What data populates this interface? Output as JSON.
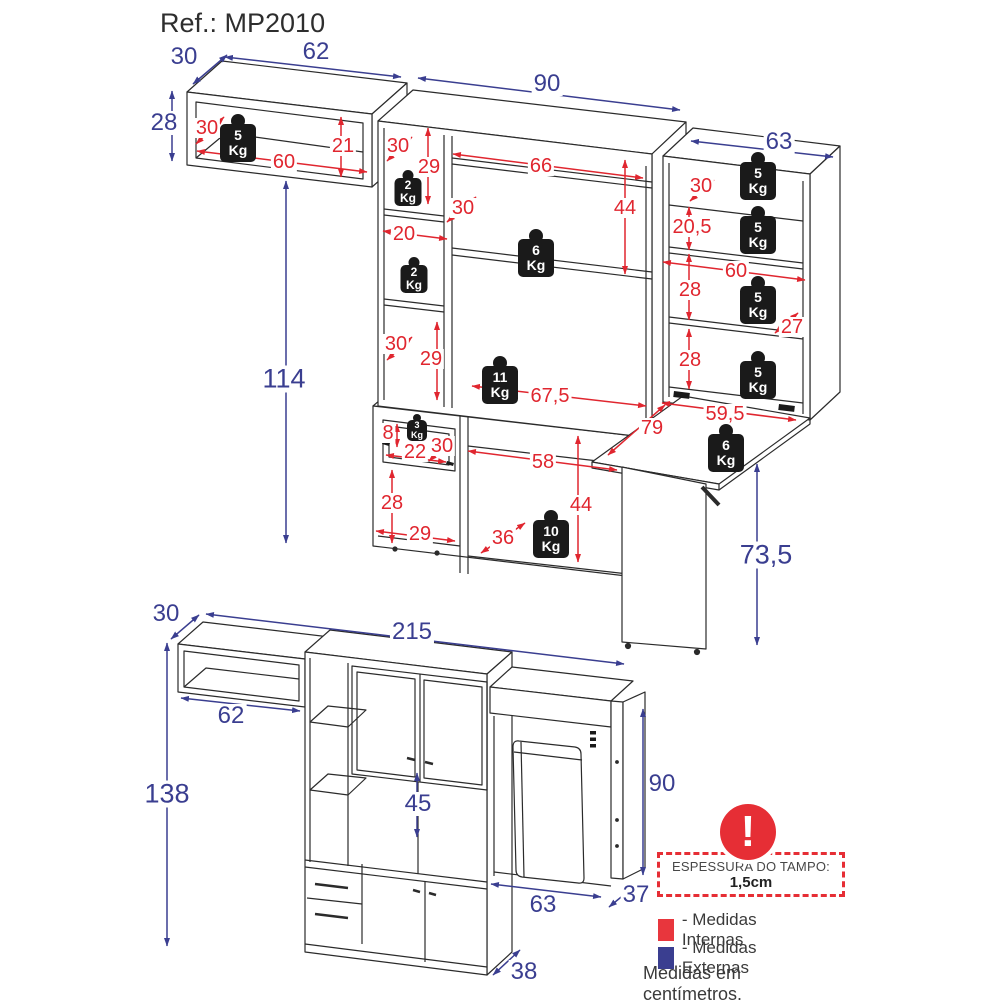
{
  "page": {
    "title": "Ref.: MP2010"
  },
  "colors": {
    "internal": "#e0262f",
    "external": "#3a3e90",
    "line": "#2b2b2b",
    "weight_fill": "#1a1a1a",
    "warning": "#e62e35"
  },
  "legend": {
    "thickness_title": "ESPESSURA DO TAMPO:",
    "thickness_value": "1,5cm",
    "internal_label": "- Medidas Internas",
    "external_label": "- Medidas Externas",
    "units_note": "Medidas em centímetros."
  },
  "dimension_labels": [
    {
      "text": "30",
      "type": "external",
      "x": 184,
      "y": 57
    },
    {
      "text": "62",
      "type": "external",
      "x": 316,
      "y": 52
    },
    {
      "text": "28",
      "type": "external",
      "x": 164,
      "y": 123
    },
    {
      "text": "90",
      "type": "external",
      "x": 547,
      "y": 84
    },
    {
      "text": "63",
      "type": "external",
      "x": 779,
      "y": 142
    },
    {
      "text": "114",
      "type": "external",
      "x": 284,
      "y": 379,
      "fs": 27
    },
    {
      "text": "73,5",
      "type": "external",
      "x": 766,
      "y": 555,
      "fs": 27
    },
    {
      "text": "30",
      "type": "external",
      "x": 166,
      "y": 614
    },
    {
      "text": "215",
      "type": "external",
      "x": 412,
      "y": 632
    },
    {
      "text": "62",
      "type": "external",
      "x": 231,
      "y": 716
    },
    {
      "text": "138",
      "type": "external",
      "x": 167,
      "y": 794,
      "fs": 27
    },
    {
      "text": "45",
      "type": "external",
      "x": 418,
      "y": 804
    },
    {
      "text": "90",
      "type": "external",
      "x": 662,
      "y": 784
    },
    {
      "text": "63",
      "type": "external",
      "x": 543,
      "y": 905
    },
    {
      "text": "37",
      "type": "external",
      "x": 636,
      "y": 895
    },
    {
      "text": "38",
      "type": "external",
      "x": 524,
      "y": 972
    },
    {
      "text": "30",
      "type": "internal",
      "x": 207,
      "y": 128
    },
    {
      "text": "21",
      "type": "internal",
      "x": 343,
      "y": 146
    },
    {
      "text": "60",
      "type": "internal",
      "x": 284,
      "y": 162
    },
    {
      "text": "30",
      "type": "internal",
      "x": 398,
      "y": 146
    },
    {
      "text": "29",
      "type": "internal",
      "x": 429,
      "y": 167
    },
    {
      "text": "20",
      "type": "internal",
      "x": 404,
      "y": 234
    },
    {
      "text": "30",
      "type": "internal",
      "x": 396,
      "y": 344
    },
    {
      "text": "29",
      "type": "internal",
      "x": 431,
      "y": 359
    },
    {
      "text": "66",
      "type": "internal",
      "x": 541,
      "y": 166
    },
    {
      "text": "44",
      "type": "internal",
      "x": 625,
      "y": 208
    },
    {
      "text": "30",
      "type": "internal",
      "x": 463,
      "y": 208
    },
    {
      "text": "67,5",
      "type": "internal",
      "x": 550,
      "y": 396
    },
    {
      "text": "8",
      "type": "internal",
      "x": 388,
      "y": 433
    },
    {
      "text": "22",
      "type": "internal",
      "x": 415,
      "y": 452
    },
    {
      "text": "30",
      "type": "internal",
      "x": 442,
      "y": 446
    },
    {
      "text": "58",
      "type": "internal",
      "x": 543,
      "y": 462
    },
    {
      "text": "44",
      "type": "internal",
      "x": 581,
      "y": 505
    },
    {
      "text": "28",
      "type": "internal",
      "x": 392,
      "y": 503
    },
    {
      "text": "29",
      "type": "internal",
      "x": 420,
      "y": 534
    },
    {
      "text": "36",
      "type": "internal",
      "x": 503,
      "y": 538
    },
    {
      "text": "30",
      "type": "internal",
      "x": 701,
      "y": 186
    },
    {
      "text": "20,5",
      "type": "internal",
      "x": 692,
      "y": 227
    },
    {
      "text": "60",
      "type": "internal",
      "x": 736,
      "y": 271
    },
    {
      "text": "28",
      "type": "internal",
      "x": 690,
      "y": 290
    },
    {
      "text": "27",
      "type": "internal",
      "x": 792,
      "y": 327
    },
    {
      "text": "28",
      "type": "internal",
      "x": 690,
      "y": 360
    },
    {
      "text": "59,5",
      "type": "internal",
      "x": 725,
      "y": 414
    },
    {
      "text": "79",
      "type": "internal",
      "x": 652,
      "y": 428
    }
  ],
  "weights": [
    {
      "value": "5",
      "unit": "Kg",
      "x": 238,
      "y": 114,
      "size": "lg"
    },
    {
      "value": "2",
      "unit": "Kg",
      "x": 408,
      "y": 170,
      "size": "md"
    },
    {
      "value": "2",
      "unit": "Kg",
      "x": 414,
      "y": 257,
      "size": "md"
    },
    {
      "value": "6",
      "unit": "Kg",
      "x": 536,
      "y": 229,
      "size": "lg"
    },
    {
      "value": "11",
      "unit": "Kg",
      "x": 500,
      "y": 356,
      "size": "lg"
    },
    {
      "value": "3",
      "unit": "Kg",
      "x": 417,
      "y": 414,
      "size": "sm"
    },
    {
      "value": "10",
      "unit": "Kg",
      "x": 551,
      "y": 510,
      "size": "lg"
    },
    {
      "value": "6",
      "unit": "Kg",
      "x": 726,
      "y": 424,
      "size": "lg"
    },
    {
      "value": "5",
      "unit": "Kg",
      "x": 758,
      "y": 152,
      "size": "lg"
    },
    {
      "value": "5",
      "unit": "Kg",
      "x": 758,
      "y": 206,
      "size": "lg"
    },
    {
      "value": "5",
      "unit": "Kg",
      "x": 758,
      "y": 276,
      "size": "lg"
    },
    {
      "value": "5",
      "unit": "Kg",
      "x": 758,
      "y": 351,
      "size": "lg"
    }
  ]
}
